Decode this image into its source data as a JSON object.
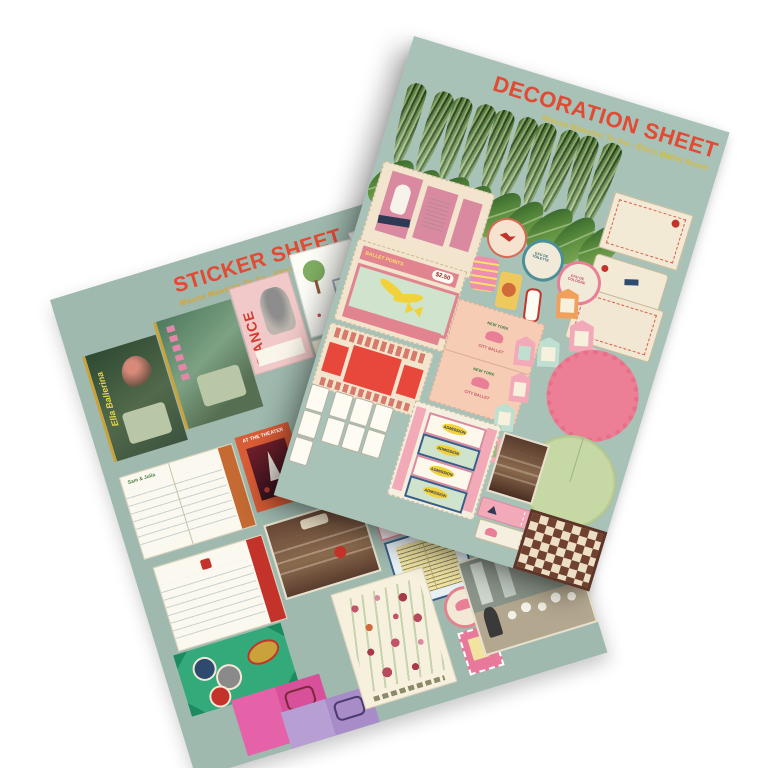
{
  "page": {
    "background_color": "#ffffff"
  },
  "sticker_sheet": {
    "title": "STICKER SHEET",
    "subtitle": "Mouse Mansion To Go - Ella's Ballet Room",
    "title_color": "#e14a33",
    "subtitle_color": "#d9a530",
    "paper_color": "#9fb9ae",
    "rotation_deg": -17,
    "items": {
      "ballerina_book_title": "Ella Ballerina",
      "dance_magazine_title": "DANCE",
      "theater_book_title": "AT THE THEATER",
      "notebook_logo": "Sam & Julia",
      "bergere_poster_fragment": "dère"
    }
  },
  "decoration_sheet": {
    "title": "DECORATION SHEET",
    "subtitle": "Mouse Mansion To Go - Ella's Ballet Room",
    "title_color": "#e14a33",
    "subtitle_color": "#d9b93a",
    "paper_color": "#a8c2b8",
    "rotation_deg": 17,
    "items": {
      "ballet_points_label": "BALLET POINTS",
      "ballet_points_price": "$2.50",
      "perfume_label_1": "EAU DE TOILETTE",
      "perfume_label_2": "EAU DE COLOGNE",
      "bag_logo_top": "NEW YORK",
      "bag_logo_bottom": "CITY BALLET",
      "ticket_label": "ADMISSION",
      "snake_plant_leaf_count": 10,
      "oval_leaf_count": 9,
      "playing_card_face_count": 5,
      "playing_card_pip_count": 5
    }
  }
}
